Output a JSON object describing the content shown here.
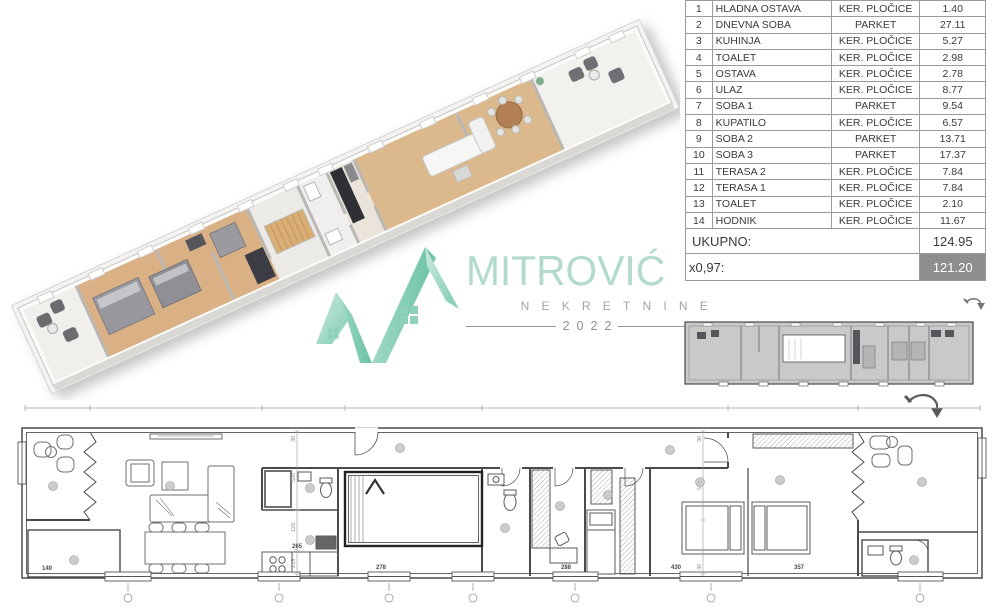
{
  "area_table": {
    "rows": [
      {
        "num": "1",
        "name": "HLADNA OSTAVA",
        "floor": "KER. PLOČICE",
        "area": "1.40"
      },
      {
        "num": "2",
        "name": "DNEVNA SOBA",
        "floor": "PARKET",
        "area": "27.11"
      },
      {
        "num": "3",
        "name": "KUHINJA",
        "floor": "KER. PLOČICE",
        "area": "5.27"
      },
      {
        "num": "4",
        "name": "TOALET",
        "floor": "KER. PLOČICE",
        "area": "2.98"
      },
      {
        "num": "5",
        "name": "OSTAVA",
        "floor": "KER. PLOČICE",
        "area": "2.78"
      },
      {
        "num": "6",
        "name": "ULAZ",
        "floor": "KER. PLOČICE",
        "area": "8.77"
      },
      {
        "num": "7",
        "name": "SOBA 1",
        "floor": "PARKET",
        "area": "9.54"
      },
      {
        "num": "8",
        "name": "KUPATILO",
        "floor": "KER. PLOČICE",
        "area": "6.57"
      },
      {
        "num": "9",
        "name": "SOBA 2",
        "floor": "PARKET",
        "area": "13.71"
      },
      {
        "num": "10",
        "name": "SOBA 3",
        "floor": "PARKET",
        "area": "17.37"
      },
      {
        "num": "11",
        "name": "TERASA 2",
        "floor": "KER. PLOČICE",
        "area": "7.84"
      },
      {
        "num": "12",
        "name": "TERASA 1",
        "floor": "KER. PLOČICE",
        "area": "7.84"
      },
      {
        "num": "13",
        "name": "TOALET",
        "floor": "KER. PLOČICE",
        "area": "2.10"
      },
      {
        "num": "14",
        "name": "HODNIK",
        "floor": "KER. PLOČICE",
        "area": "11.67"
      }
    ],
    "total_label": "UKUPNO:",
    "total_value": "124.95",
    "factor_label": "x0,97:",
    "factor_value": "121.20"
  },
  "logo": {
    "title": "MITROVIĆ",
    "subtitle": "NEKRETNINE",
    "year": "2022"
  },
  "plan": {
    "dims": {
      "d140": "140",
      "d265": "265",
      "d278": "278",
      "d288": "288",
      "d430": "430",
      "d357": "357",
      "v30": "30",
      "v520": "520",
      "v125": "125",
      "v215": "215"
    }
  },
  "colors": {
    "mint": "#8fd0b8",
    "mint_light": "#cdeade",
    "logo_text": "#b2dbce",
    "subtitle_gray": "#a3a3a3",
    "table_border": "#9b9b9b",
    "highlight_bg": "#8e8e8e",
    "wood_floor": "#d9b185",
    "thumb_gray": "#c9c9ca"
  }
}
